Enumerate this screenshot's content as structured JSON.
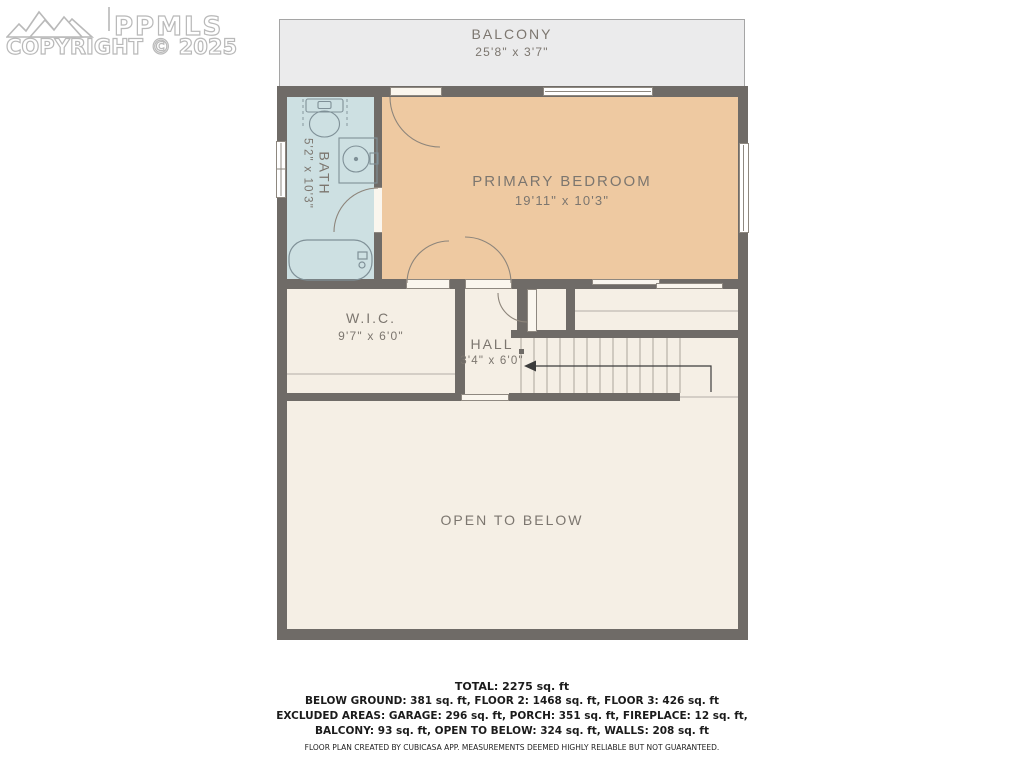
{
  "watermark": {
    "brand": "PPMLS",
    "copyright": "COPYRIGHT © 2025"
  },
  "floorplan": {
    "rooms": {
      "balcony": {
        "name": "BALCONY",
        "dims": "25'8\" x 3'7\""
      },
      "primary_bedroom": {
        "name": "PRIMARY BEDROOM",
        "dims": "19'11\" x 10'3\""
      },
      "bath": {
        "name": "BATH",
        "dims": "5'2\" x 10'3\""
      },
      "wic": {
        "name": "W.I.C.",
        "dims": "9'7\" x 6'0\""
      },
      "hall": {
        "name": "HALL",
        "dims": "3'4\" x 6'0\""
      },
      "open_to_below": {
        "name": "OPEN TO BELOW"
      }
    },
    "features": [
      "stairs-with-down-arrow",
      "bathtub",
      "toilet",
      "sink",
      "sliding-closet-door",
      "balcony-door",
      "windows"
    ]
  },
  "summary": {
    "total": "TOTAL: 2275 sq. ft",
    "floors": "BELOW GROUND: 381 sq. ft, FLOOR 2: 1468 sq. ft, FLOOR 3: 426 sq. ft",
    "excluded_1": "EXCLUDED AREAS: GARAGE: 296 sq. ft, PORCH: 351 sq. ft, FIREPLACE: 12 sq. ft,",
    "excluded_2": "BALCONY: 93 sq. ft, OPEN TO BELOW: 324 sq. ft, WALLS: 208 sq. ft",
    "disclaimer": "FLOOR PLAN CREATED BY CUBICASA APP. MEASUREMENTS DEEMED HIGHLY RELIABLE BUT NOT GUARANTEED."
  },
  "colors": {
    "wall": "#6f6b67",
    "bedroom_fill": "#eec9a1",
    "bath_fill": "#cde0e2",
    "floor_fill": "#f5efe5",
    "balcony_fill": "#ebebec",
    "label_text": "#7c766f",
    "summary_text": "#1b1b1b"
  }
}
